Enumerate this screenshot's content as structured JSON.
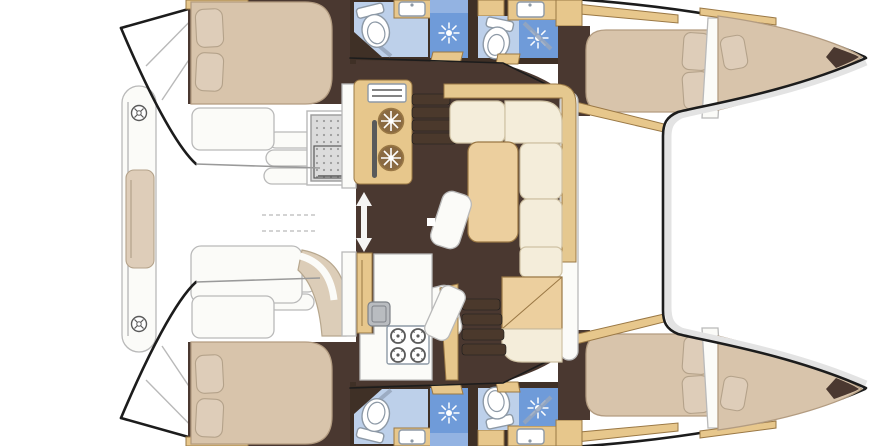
{
  "meta": {
    "subject": "catamaran-interior-floor-plan",
    "view": "top-down-deck-plan",
    "hulls": 2
  },
  "plan": {
    "double_bed_cabins": 4,
    "bow_berths": 2,
    "bathrooms": 4,
    "showers": 4,
    "toilets": 4,
    "bathroom_sinks": 4,
    "galley_round_sinks": 2,
    "stove_burners": 4,
    "saloon_sofa": "L-shaped with table and two stools",
    "companionway_step_flights": 2,
    "cockpit_items": [
      "grid-top-fridge-box",
      "curved-bench",
      "white-table-pad"
    ],
    "foredeck": "solid platform between bows",
    "aft_platform": "cross beam with two winches and cushion pad"
  },
  "icons": {
    "shower": "starburst-spray",
    "galley_sink": "snowflake-in-circle",
    "stove_burner": "ring-with-ticks",
    "deck_hardware": "circle-with-cross-winch",
    "companionway_entry": "double-vertical-arrow"
  },
  "colors": {
    "white": "#ffffff",
    "off_white": "#fbfbf8",
    "outline": "#1c1c1c",
    "line_gray": "#b9b9b9",
    "mid_gray": "#9a9a9a",
    "shade": "#e3e3e3",
    "floor": "#4a3830",
    "wall": "#3f3026",
    "wood": "#e7c78c",
    "wood_border": "#9a7845",
    "wood_deep": "#8a6a42",
    "table": "#eccf9e",
    "cream": "#f4edda",
    "cream_border": "#cfc2a4",
    "backrest": "#e5c88f",
    "bed": "#d8c4ab",
    "bed_border": "#b39c81",
    "pillow": "#decdb9",
    "pillow_border": "#b4a28a",
    "tile": "#bdd0ea",
    "shower": "#6f9bd9",
    "shower_top": "#93b3e2",
    "fixture_border": "#8d99a6",
    "glass": "#97a6bc",
    "grid": "#dcdcdc",
    "grid_dot": "#9b9b9b",
    "steel": "#b9bcc0",
    "steel_border": "#7e8288",
    "step": "#4b392c",
    "icon_gray": "#5a5a5a",
    "bench": "#dccdb8",
    "bench_border": "#b7a78e"
  }
}
